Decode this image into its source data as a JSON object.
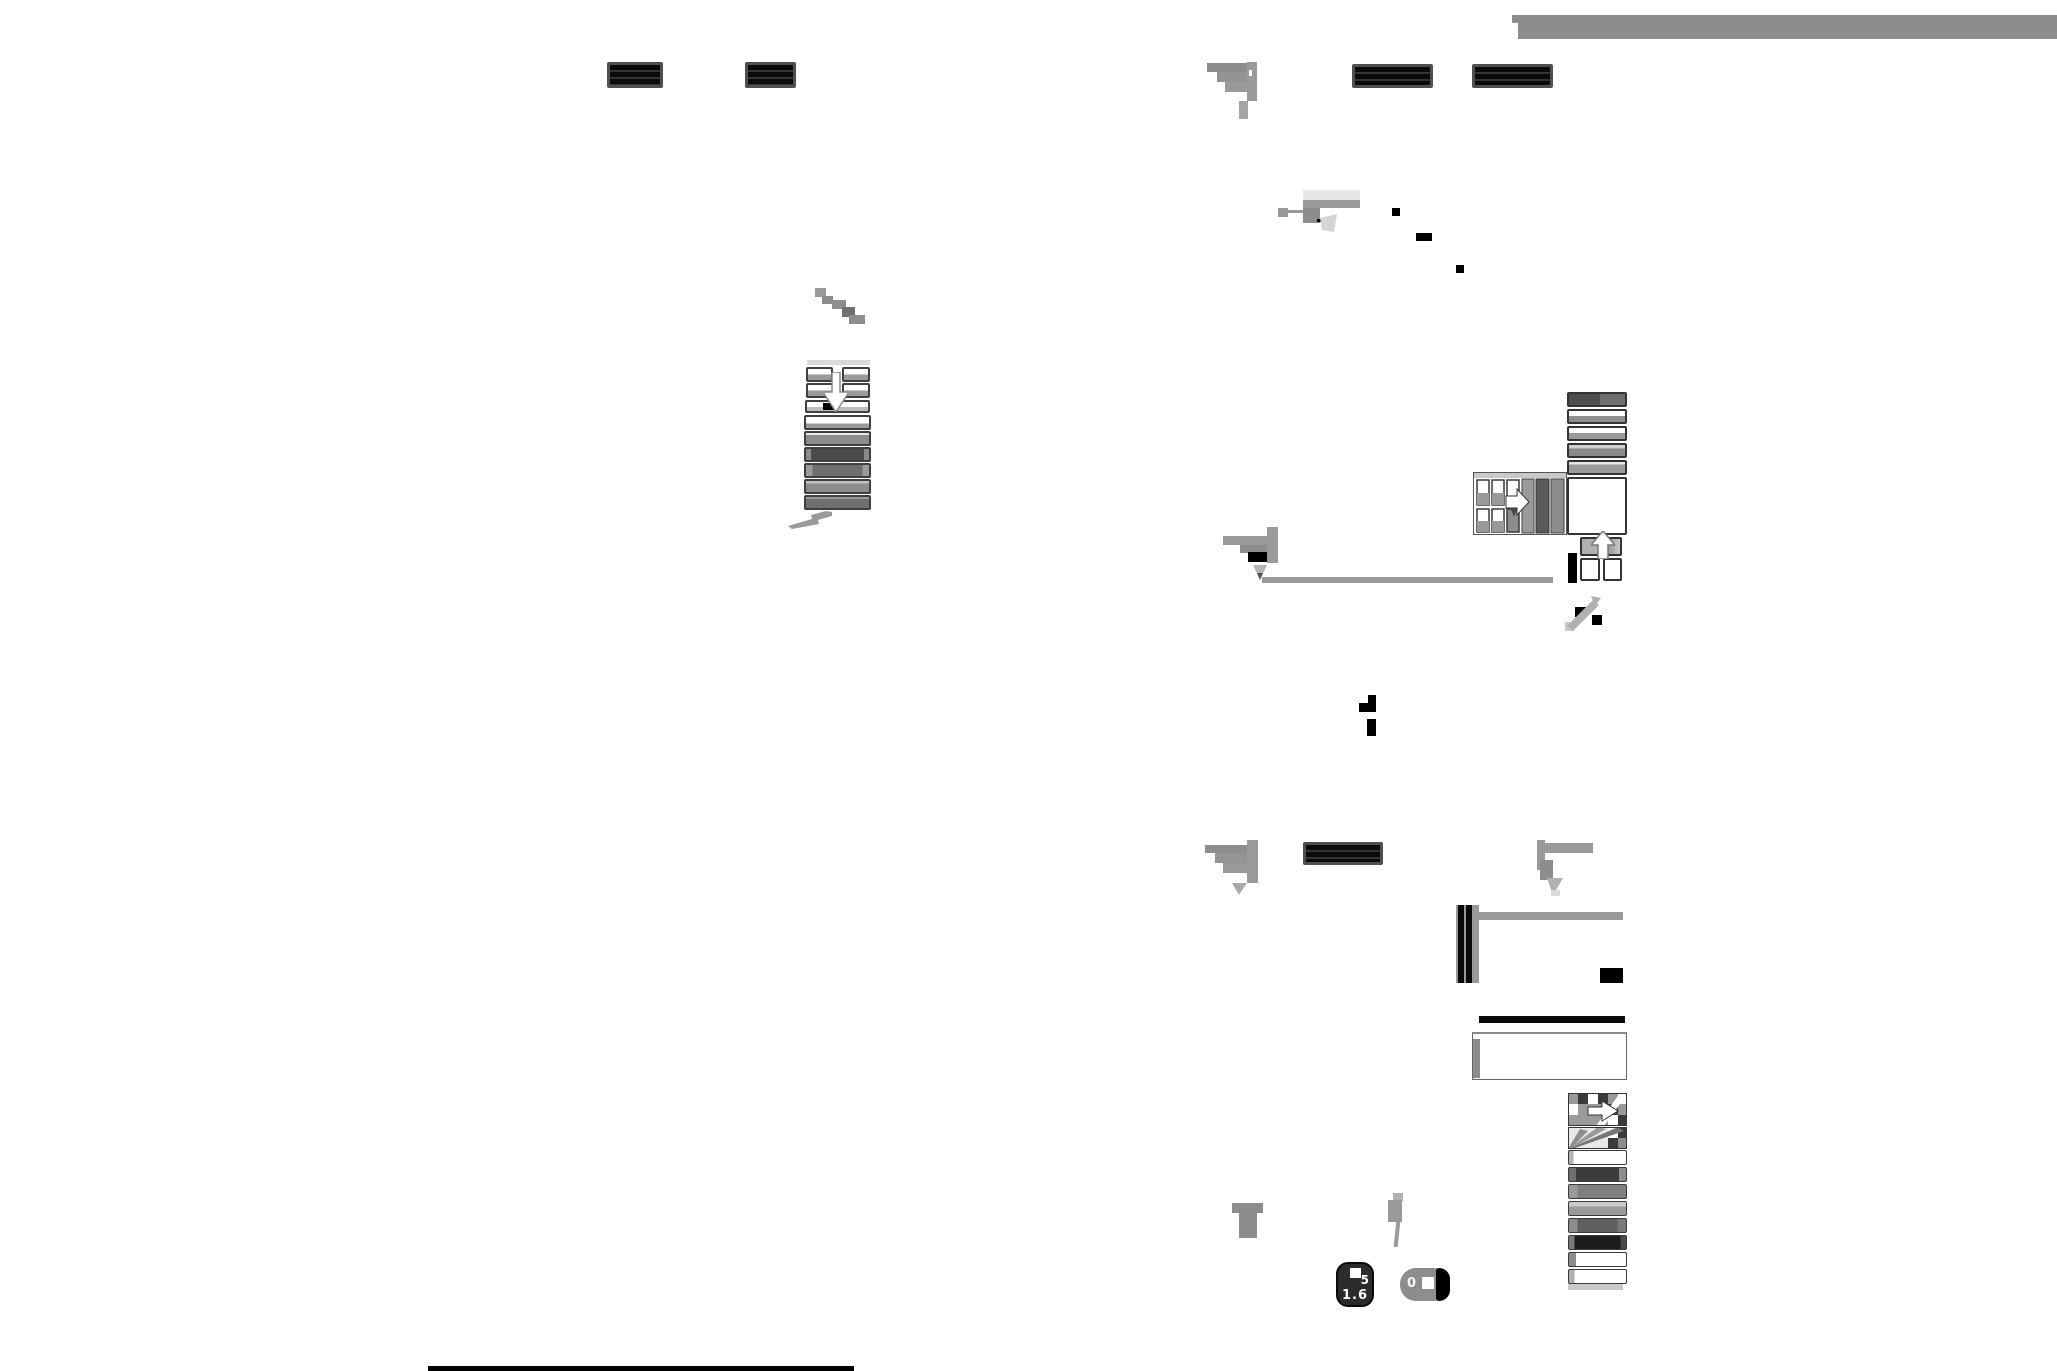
{
  "page": {
    "kind": "scanned-document-sheet",
    "background": "#ffffff",
    "description": "Heavily downscaled scanned form with redacted bars, handwriting scribbles and small diagram blocks"
  },
  "palette": {
    "ink_black": "#000000",
    "redaction_frame": "#4f4f4f",
    "scan_gray": "#8d8d8d",
    "light_gray": "#c9c9c9",
    "header_bar_gray": "#8d8d8d",
    "paper_white": "#ffffff"
  },
  "redactions": {
    "count": 5
  },
  "flow_stack": {
    "rows": [
      {
        "fill": "linear-gradient(180deg,#ffffff 60%,#9a9a9a 60%)"
      },
      {
        "fill": "linear-gradient(180deg,#e8e8e8 20%,#8d8d8d 20%)"
      },
      {
        "fill": "linear-gradient(90deg,#8a8a8a 0 8%,#4a4a4a 8% 92%,#8a8a8a 92%)"
      },
      {
        "fill": "linear-gradient(90deg,#9a9a9a 0 10%,#6f6f6f 10% 90%,#9a9a9a 90%)"
      },
      {
        "fill": "linear-gradient(180deg,#c0c0c0 25%,#8d8d8d 25%)"
      },
      {
        "fill": "linear-gradient(180deg,#9a9a9a 20%,#6f6f6f 20%)"
      }
    ]
  },
  "wide_stack": {
    "boxes": [
      {
        "fill": "linear-gradient(90deg,#4f4f4f 0 55%,#6e6e6e 55%)"
      },
      {
        "fill": "linear-gradient(180deg,#ffffff 45%,#8f8f8f 45%)"
      },
      {
        "fill": "linear-gradient(180deg,#ffffff 45%,#9a9a9a 45%)"
      },
      {
        "fill": "linear-gradient(180deg,#cfcfcf 30%,#8a8a8a 30%)"
      },
      {
        "fill": "linear-gradient(180deg,#e5e5e5 25%,#9a9a9a 25%)"
      }
    ]
  },
  "right_stack": {
    "rows": [
      {
        "fill": "linear-gradient(90deg,#b5b5b5 0 8%,#ffffff 8%)"
      },
      {
        "fill": "linear-gradient(90deg,#6e6e6e 0 12%,#3c3c3c 12% 88%,#8d8d8d 88%)"
      },
      {
        "fill": "linear-gradient(90deg,#9a9a9a 0 15%,#7f7f7f 15%)"
      },
      {
        "fill": "linear-gradient(180deg,#c9c9c9 35%,#9a9a9a 35%)"
      },
      {
        "fill": "linear-gradient(90deg,#8d8d8d 0 15%,#5f5f5f 15% 85%,#7a7a7a 85%)"
      },
      {
        "fill": "linear-gradient(90deg,#7a7a7a 0 10%,#1c1c1c 10% 90%,#4a4a4a 90%)"
      },
      {
        "fill": "linear-gradient(90deg,#8d8d8d 0 12%,#ffffff 12%)"
      },
      {
        "fill": "linear-gradient(90deg,#b0b0b0 0 10%,#ffffff 10%)"
      }
    ]
  },
  "lens_front_icon": {
    "top_value": "5",
    "bottom_value": "1.6"
  },
  "lens_side_icon": {
    "value": "0"
  }
}
